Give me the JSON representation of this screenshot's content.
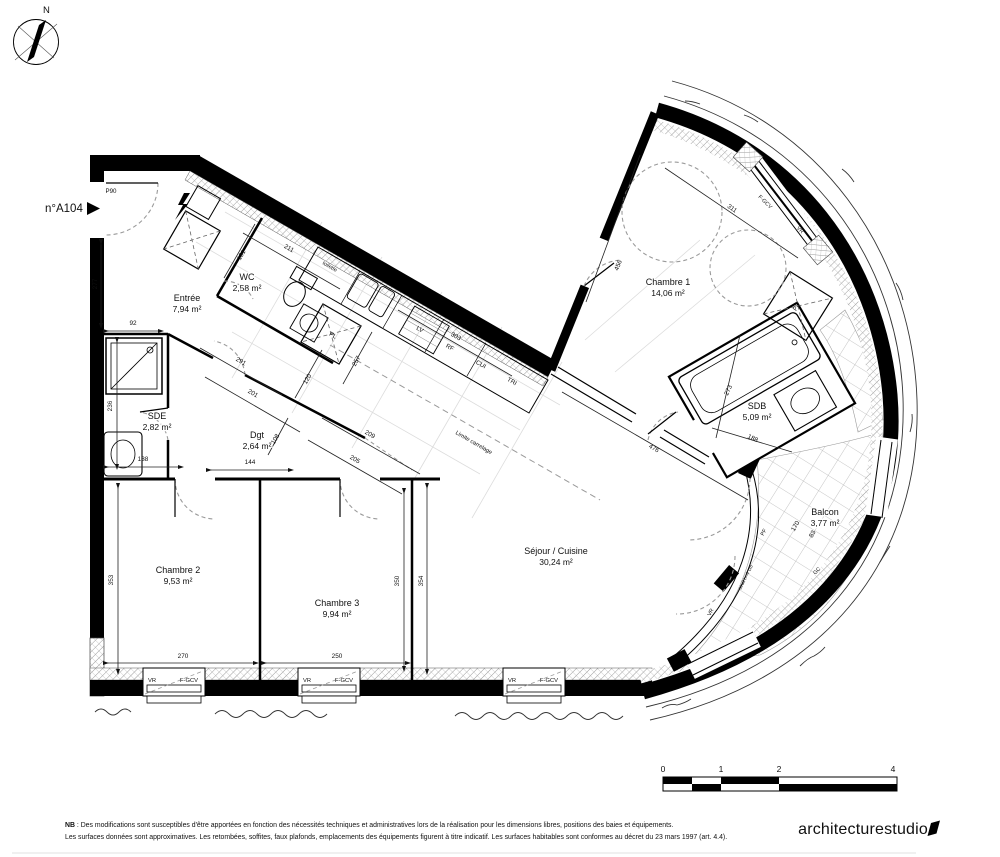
{
  "plan": {
    "unit_label": "n°A104",
    "north_label": "N",
    "colors": {
      "wall": "#000000",
      "paper": "#ffffff",
      "dashed": "#9a9a9a",
      "tile_line": "#b5b5b5"
    }
  },
  "rooms": [
    {
      "name": "Entrée",
      "area": "7,94 m²",
      "x": 187,
      "y": 301
    },
    {
      "name": "WC",
      "area": "2,58 m²",
      "x": 247,
      "y": 280
    },
    {
      "name": "SDE",
      "area": "2,82 m²",
      "x": 157,
      "y": 419
    },
    {
      "name": "Dgt",
      "area": "2,64 m²",
      "x": 257,
      "y": 438
    },
    {
      "name": "Chambre 1",
      "area": "14,06 m²",
      "x": 668,
      "y": 285
    },
    {
      "name": "Chambre 2",
      "area": "9,53 m²",
      "x": 178,
      "y": 573
    },
    {
      "name": "Chambre 3",
      "area": "9,94 m²",
      "x": 337,
      "y": 606
    },
    {
      "name": "SDB",
      "area": "5,09 m²",
      "x": 757,
      "y": 409
    },
    {
      "name": "Séjour / Cuisine",
      "area": "30,24 m²",
      "x": 556,
      "y": 554
    },
    {
      "name": "Balcon",
      "area": "3,77 m²",
      "x": 825,
      "y": 515
    }
  ],
  "dimensions": [
    {
      "v": "277",
      "x": 97,
      "y": 284,
      "r": -90
    },
    {
      "v": "92",
      "x": 133,
      "y": 325,
      "r": 0
    },
    {
      "v": "236",
      "x": 112,
      "y": 406,
      "r": -90
    },
    {
      "v": "353",
      "x": 113,
      "y": 580,
      "r": -90
    },
    {
      "v": "270",
      "x": 183,
      "y": 658,
      "r": 0
    },
    {
      "v": "250",
      "x": 337,
      "y": 658,
      "r": 0
    },
    {
      "v": "350",
      "x": 399,
      "y": 581,
      "r": -90
    },
    {
      "v": "354",
      "x": 423,
      "y": 581,
      "r": -90
    },
    {
      "v": "138",
      "x": 143,
      "y": 461,
      "r": 0
    },
    {
      "v": "144",
      "x": 250,
      "y": 464,
      "r": 0
    },
    {
      "v": "291",
      "x": 240,
      "y": 363,
      "r": 30
    },
    {
      "v": "201",
      "x": 252,
      "y": 395,
      "r": 30
    },
    {
      "v": "211",
      "x": 288,
      "y": 250,
      "r": 30
    },
    {
      "v": "131",
      "x": 243,
      "y": 256,
      "r": -60
    },
    {
      "v": "120",
      "x": 309,
      "y": 380,
      "r": -60
    },
    {
      "v": "257",
      "x": 358,
      "y": 362,
      "r": -60
    },
    {
      "v": "303",
      "x": 455,
      "y": 338,
      "r": 30
    },
    {
      "v": "209",
      "x": 369,
      "y": 436,
      "r": 30
    },
    {
      "v": "205",
      "x": 354,
      "y": 461,
      "r": 30
    },
    {
      "v": "108",
      "x": 277,
      "y": 440,
      "r": -60
    },
    {
      "v": "456",
      "x": 620,
      "y": 266,
      "r": -68
    },
    {
      "v": "311",
      "x": 731,
      "y": 210,
      "r": 35
    },
    {
      "v": "476",
      "x": 653,
      "y": 450,
      "r": 30
    },
    {
      "v": "273",
      "x": 730,
      "y": 391,
      "r": -65
    },
    {
      "v": "188",
      "x": 752,
      "y": 440,
      "r": 25
    },
    {
      "v": "170",
      "x": 797,
      "y": 527,
      "r": -60
    },
    {
      "v": "83",
      "x": 814,
      "y": 535,
      "r": -60
    }
  ],
  "annotations": [
    {
      "t": "P90",
      "x": 111,
      "y": 193,
      "r": 0,
      "s": 6.2
    },
    {
      "t": "toilette",
      "x": 329,
      "y": 268,
      "r": 30,
      "s": 5.4
    },
    {
      "t": "PL",
      "x": 332,
      "y": 337,
      "r": 30,
      "s": 6.2
    },
    {
      "t": "PL",
      "x": 798,
      "y": 308,
      "r": -58,
      "s": 6.2
    },
    {
      "t": "LV",
      "x": 419,
      "y": 331,
      "r": 30,
      "s": 6.2
    },
    {
      "t": "RF",
      "x": 449,
      "y": 349,
      "r": 30,
      "s": 6.2
    },
    {
      "t": "CUI",
      "x": 480,
      "y": 366,
      "r": 30,
      "s": 6.2
    },
    {
      "t": "TRI",
      "x": 511,
      "y": 383,
      "r": 30,
      "s": 6.2
    },
    {
      "t": "Limite carrelage",
      "x": 473,
      "y": 444,
      "r": 30,
      "s": 5.8,
      "c": "#9a9a9a"
    },
    {
      "t": "F-GCV",
      "x": 764,
      "y": 203,
      "r": 44,
      "s": 5.4
    },
    {
      "t": "VR",
      "x": 799,
      "y": 231,
      "r": 46,
      "s": 5.4
    },
    {
      "t": "PF",
      "x": 765,
      "y": 533,
      "r": -62,
      "s": 5.4
    },
    {
      "t": "GC",
      "x": 818,
      "y": 572,
      "r": -46,
      "s": 5.4
    },
    {
      "t": "VR",
      "x": 712,
      "y": 613,
      "r": -62,
      "s": 5.4
    },
    {
      "t": "seuil h=4 cm",
      "x": 747,
      "y": 578,
      "r": -63,
      "s": 4.8,
      "c": "#555555"
    },
    {
      "t": "VR",
      "x": 152,
      "y": 682,
      "r": 0,
      "s": 5.8
    },
    {
      "t": "F-GCV",
      "x": 189,
      "y": 682,
      "r": 0,
      "s": 5.8
    },
    {
      "t": "VR",
      "x": 307,
      "y": 682,
      "r": 0,
      "s": 5.8
    },
    {
      "t": "F-GCV",
      "x": 344,
      "y": 682,
      "r": 0,
      "s": 5.8
    },
    {
      "t": "VR",
      "x": 512,
      "y": 682,
      "r": 0,
      "s": 5.8
    },
    {
      "t": "F-GCV",
      "x": 549,
      "y": 682,
      "r": 0,
      "s": 5.8
    }
  ],
  "scalebar": {
    "labels": [
      "0",
      "1",
      "2",
      "4"
    ]
  },
  "note": {
    "prefix": "NB",
    "line1": " : Des modifications sont susceptibles d'être apportées en fonction des nécessités techniques et administratives lors de la réalisation pour les dimensions libres, positions des baies et équipements.",
    "line2": "Les surfaces données sont approximatives. Les retombées, soffites, faux plafonds, emplacements des équipements figurent à titre indicatif. Les surfaces habitables sont conformes au décret du 23 mars 1997 (art. 4.4)."
  },
  "logo": {
    "text": "architecturestudio"
  }
}
